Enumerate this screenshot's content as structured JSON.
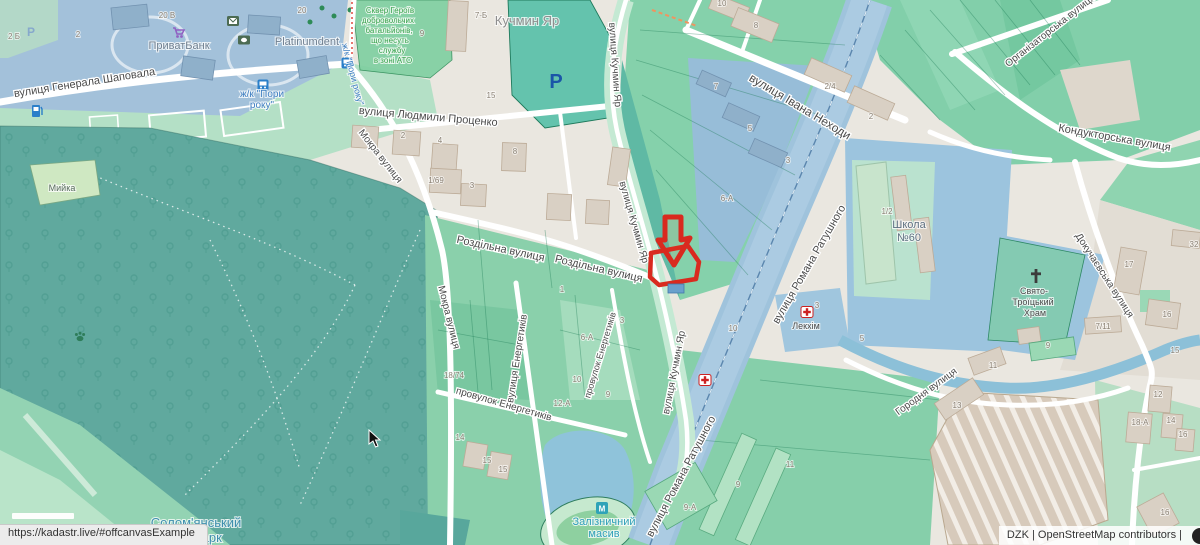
{
  "page": {
    "url_bar": "https://kadastr.live/#offcanvasExample",
    "attribution": "DZK | OpenStreetMap contributors |"
  },
  "map": {
    "colors": {
      "marker_red": "#d92a1f",
      "forest": "#60a99e",
      "parcel_green": "#8ad0ab",
      "zone_blue": "#a3c1da",
      "road_band_blue": "#9fc3dc",
      "water": "#8cc0d8",
      "building_beige": "#d9d0c4"
    },
    "street_labels": [
      {
        "text": "вулиця Генерала Шаповала",
        "x": 85,
        "y": 86,
        "rot": -9,
        "size": 11
      },
      {
        "text": "вулиця Людмили Проценко",
        "x": 428,
        "y": 120,
        "rot": 5,
        "size": 11
      },
      {
        "text": "Мокра вулиця",
        "x": 378,
        "y": 158,
        "rot": 52,
        "size": 10
      },
      {
        "text": "Мокра вулиця",
        "x": 446,
        "y": 318,
        "rot": 76,
        "size": 10
      },
      {
        "text": "Роздільна вулиця",
        "x": 500,
        "y": 252,
        "rot": 12,
        "size": 11
      },
      {
        "text": "Роздільна вулиця",
        "x": 598,
        "y": 272,
        "rot": 13,
        "size": 11
      },
      {
        "text": "вулиця Кучмин Яр",
        "x": 612,
        "y": 65,
        "rot": 86,
        "size": 10
      },
      {
        "text": "вулиця Кучмин Яр",
        "x": 631,
        "y": 223,
        "rot": 74,
        "size": 10
      },
      {
        "text": "вулиця Кучмин Яр",
        "x": 677,
        "y": 373,
        "rot": -79,
        "size": 10
      },
      {
        "text": "вулиця Івана Неходи",
        "x": 798,
        "y": 110,
        "rot": 31,
        "size": 12
      },
      {
        "text": "Організаторська вулиця",
        "x": 1052,
        "y": 33,
        "rot": -38,
        "size": 10
      },
      {
        "text": "Кондукторська вулиця",
        "x": 1114,
        "y": 141,
        "rot": 10,
        "size": 11
      },
      {
        "text": "Докучаєвська вулиця",
        "x": 1102,
        "y": 277,
        "rot": 57,
        "size": 10
      },
      {
        "text": "вулиця Романа Ратушного",
        "x": 812,
        "y": 266,
        "rot": -60,
        "size": 11
      },
      {
        "text": "вулиця Романа Ратушного",
        "x": 684,
        "y": 478,
        "rot": -62,
        "size": 11
      },
      {
        "text": "вулиця Енергетиків",
        "x": 520,
        "y": 359,
        "rot": -81,
        "size": 10
      },
      {
        "text": "провулок Енергетиків",
        "x": 503,
        "y": 407,
        "rot": 16,
        "size": 10
      },
      {
        "text": "провулок Енергетиків",
        "x": 603,
        "y": 356,
        "rot": -73,
        "size": 9
      },
      {
        "text": "Городня вулиця",
        "x": 928,
        "y": 394,
        "rot": -36,
        "size": 10
      }
    ],
    "area_labels": [
      {
        "text": "Кучмин Яр",
        "x": 527,
        "y": 25,
        "rot": 0,
        "size": 13,
        "color": "#8e8e8e"
      },
      {
        "text": "ПриватБанк",
        "x": 179,
        "y": 49,
        "rot": 0,
        "size": 11,
        "color": "#6f7f90"
      },
      {
        "text": "Platinumdent",
        "x": 307,
        "y": 45,
        "rot": 0,
        "size": 11,
        "color": "#6f7f90"
      },
      {
        "text": "Мийка",
        "x": 62,
        "y": 191,
        "rot": 0,
        "size": 9,
        "color": "#586b5d"
      },
      {
        "text": "ж/к \"Пори",
        "x": 262,
        "y": 97,
        "rot": 0,
        "size": 10,
        "color": "#3f7fc1"
      },
      {
        "text": "року\"",
        "x": 262,
        "y": 108,
        "rot": 0,
        "size": 10,
        "color": "#3f7fc1"
      },
      {
        "text": "ж/к \"Пори року\"",
        "x": 350,
        "y": 75,
        "rot": 75,
        "size": 9,
        "color": "#3f7fc1"
      },
      {
        "text": "Сквер Героїв",
        "x": 390,
        "y": 13,
        "rot": 0,
        "size": 8,
        "color": "#37a24a"
      },
      {
        "text": "добровольчих",
        "x": 388,
        "y": 23,
        "rot": 0,
        "size": 8,
        "color": "#37a24a"
      },
      {
        "text": "батальйонів,",
        "x": 389,
        "y": 33,
        "rot": 0,
        "size": 8,
        "color": "#37a24a"
      },
      {
        "text": "що несуть",
        "x": 390,
        "y": 43,
        "rot": 0,
        "size": 8,
        "color": "#37a24a"
      },
      {
        "text": "службу",
        "x": 392,
        "y": 53,
        "rot": 0,
        "size": 8,
        "color": "#37a24a"
      },
      {
        "text": "в зоні АТО",
        "x": 393,
        "y": 63,
        "rot": 0,
        "size": 8,
        "color": "#37a24a"
      },
      {
        "text": "Школа",
        "x": 909,
        "y": 228,
        "rot": 0,
        "size": 11,
        "color": "#5d6f80"
      },
      {
        "text": "№60",
        "x": 909,
        "y": 241,
        "rot": 0,
        "size": 11,
        "color": "#5d6f80"
      },
      {
        "text": "Свято-",
        "x": 1034,
        "y": 294,
        "rot": 0,
        "size": 9,
        "color": "#4a4a4a"
      },
      {
        "text": "Троїцький",
        "x": 1033,
        "y": 305,
        "rot": 0,
        "size": 9,
        "color": "#4a4a4a"
      },
      {
        "text": "Храм",
        "x": 1035,
        "y": 316,
        "rot": 0,
        "size": 9,
        "color": "#4a4a4a"
      },
      {
        "text": "Лекхім",
        "x": 806,
        "y": 329,
        "rot": 0,
        "size": 9,
        "color": "#4a4a4a"
      },
      {
        "text": "Залізничний",
        "x": 604,
        "y": 525,
        "rot": 0,
        "size": 11,
        "color": "#2e9fb8"
      },
      {
        "text": "масив",
        "x": 604,
        "y": 537,
        "rot": 0,
        "size": 11,
        "color": "#2e9fb8"
      },
      {
        "text": "Солом'янський",
        "x": 196,
        "y": 527,
        "rot": 0,
        "size": 13,
        "color": "#3f8fae"
      },
      {
        "text": "лісопарк",
        "x": 196,
        "y": 542,
        "rot": 0,
        "size": 13,
        "color": "#3f8fae"
      }
    ],
    "house_numbers": [
      {
        "text": "20 В",
        "x": 167,
        "y": 18
      },
      {
        "text": "20",
        "x": 302,
        "y": 13
      },
      {
        "text": "2 Б",
        "x": 14,
        "y": 39
      },
      {
        "text": "2",
        "x": 78,
        "y": 37
      },
      {
        "text": "7-Б",
        "x": 481,
        "y": 18
      },
      {
        "text": "9",
        "x": 422,
        "y": 36
      },
      {
        "text": "15",
        "x": 491,
        "y": 98
      },
      {
        "text": "2",
        "x": 403,
        "y": 138
      },
      {
        "text": "4",
        "x": 440,
        "y": 143
      },
      {
        "text": "1/69",
        "x": 436,
        "y": 183
      },
      {
        "text": "3",
        "x": 472,
        "y": 188
      },
      {
        "text": "8",
        "x": 515,
        "y": 154
      },
      {
        "text": "10",
        "x": 722,
        "y": 6
      },
      {
        "text": "8",
        "x": 756,
        "y": 28
      },
      {
        "text": "2/4",
        "x": 830,
        "y": 89
      },
      {
        "text": "2",
        "x": 871,
        "y": 119
      },
      {
        "text": "7",
        "x": 716,
        "y": 89
      },
      {
        "text": "5",
        "x": 750,
        "y": 131
      },
      {
        "text": "3",
        "x": 788,
        "y": 163
      },
      {
        "text": "6-А",
        "x": 727,
        "y": 201
      },
      {
        "text": "1/2",
        "x": 887,
        "y": 214
      },
      {
        "text": "5",
        "x": 862,
        "y": 341
      },
      {
        "text": "17",
        "x": 1129,
        "y": 267
      },
      {
        "text": "32",
        "x": 1194,
        "y": 247
      },
      {
        "text": "16",
        "x": 1167,
        "y": 317
      },
      {
        "text": "7/11",
        "x": 1103,
        "y": 329
      },
      {
        "text": "15",
        "x": 1175,
        "y": 353
      },
      {
        "text": "13",
        "x": 957,
        "y": 408
      },
      {
        "text": "11",
        "x": 993,
        "y": 368
      },
      {
        "text": "9",
        "x": 1048,
        "y": 348
      },
      {
        "text": "18-А",
        "x": 1140,
        "y": 425
      },
      {
        "text": "12",
        "x": 1158,
        "y": 397
      },
      {
        "text": "14",
        "x": 1171,
        "y": 423
      },
      {
        "text": "16",
        "x": 1183,
        "y": 437
      },
      {
        "text": "16",
        "x": 1165,
        "y": 515
      },
      {
        "text": "18/74",
        "x": 454,
        "y": 378
      },
      {
        "text": "12-А",
        "x": 562,
        "y": 406
      },
      {
        "text": "10",
        "x": 577,
        "y": 382
      },
      {
        "text": "6-А",
        "x": 587,
        "y": 340
      },
      {
        "text": "3",
        "x": 622,
        "y": 323
      },
      {
        "text": "1",
        "x": 562,
        "y": 292
      },
      {
        "text": "9",
        "x": 608,
        "y": 397
      },
      {
        "text": "14",
        "x": 460,
        "y": 440
      },
      {
        "text": "15",
        "x": 487,
        "y": 463
      },
      {
        "text": "15",
        "x": 503,
        "y": 472
      },
      {
        "text": "9-А",
        "x": 690,
        "y": 510
      },
      {
        "text": "9",
        "x": 738,
        "y": 487
      },
      {
        "text": "11",
        "x": 790,
        "y": 467
      },
      {
        "text": "10",
        "x": 733,
        "y": 331
      },
      {
        "text": "3",
        "x": 817,
        "y": 308
      }
    ],
    "icons": [
      {
        "name": "mail",
        "type": "envelope",
        "x": 233,
        "y": 21,
        "bg": "#4c6b52"
      },
      {
        "name": "atm",
        "type": "banknote",
        "x": 244,
        "y": 40,
        "bg": "#4c6b52"
      },
      {
        "name": "shop-cart",
        "type": "cart",
        "x": 178,
        "y": 32,
        "bg": "#9061c2"
      },
      {
        "name": "bus-stop",
        "type": "bus",
        "x": 263,
        "y": 85,
        "bg": "#2a7fc9"
      },
      {
        "name": "bus-stop",
        "type": "bus",
        "x": 347,
        "y": 63,
        "bg": "#2a7fc9"
      },
      {
        "name": "fuel-station",
        "type": "fuel",
        "x": 37,
        "y": 111,
        "bg": "#2a7fc9"
      },
      {
        "name": "parking",
        "type": "text",
        "char": "P",
        "x": 556,
        "y": 88,
        "bg": "#1a56a8",
        "size": 20
      },
      {
        "name": "parking",
        "type": "text",
        "char": "P",
        "x": 31,
        "y": 36,
        "bg": "#86a8cc",
        "size": 12
      },
      {
        "name": "metro-station",
        "type": "box",
        "char": "М",
        "x": 602,
        "y": 508,
        "bg": "#2fa3b8"
      },
      {
        "name": "pharmacy",
        "type": "pharmacy",
        "x": 705,
        "y": 380,
        "bg": "#cc2222"
      },
      {
        "name": "pharmacy",
        "type": "pharmacy",
        "x": 807,
        "y": 312,
        "bg": "#cc2222"
      },
      {
        "name": "church-cross",
        "type": "cross",
        "x": 1036,
        "y": 276,
        "bg": "#3c3c3c"
      },
      {
        "name": "dog-park-paw",
        "type": "paw",
        "x": 80,
        "y": 336,
        "bg": "#2e7d5a"
      },
      {
        "name": "mouse-cursor",
        "type": "cursor",
        "x": 369,
        "y": 430,
        "bg": "#111111"
      }
    ],
    "marker": {
      "type": "arrow-down-highlight",
      "color": "#d92a1f"
    }
  }
}
